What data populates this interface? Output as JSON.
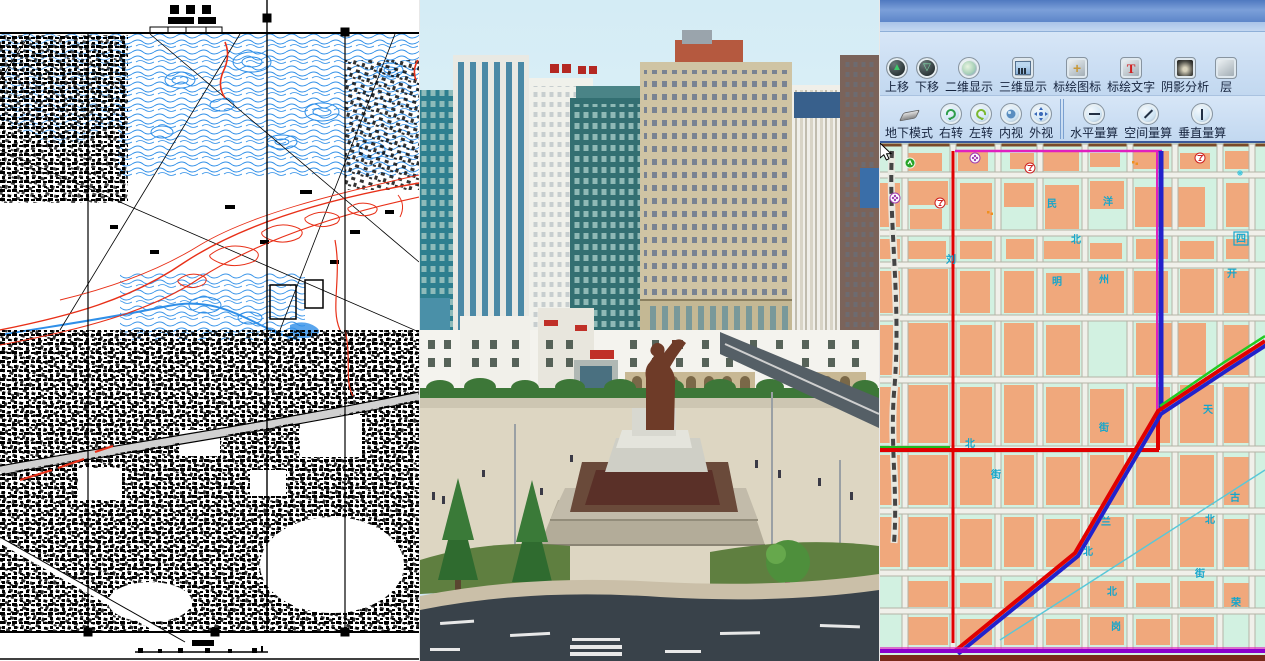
{
  "composite": {
    "panels": [
      "cad-topographic-map",
      "3d-city-model-view",
      "gis-application"
    ]
  },
  "left_panel": {
    "type": "scanned CAD/topographic city map",
    "colors": {
      "ink": "#000000",
      "contour_blue": "#2f8fe8",
      "contour_red": "#e83018",
      "paper": "#ffffff"
    }
  },
  "middle_panel": {
    "type": "3D virtual city scene with statue plaza",
    "colors": {
      "sky": "#d8edf5",
      "plaza": "#ddd6c2",
      "road": "#39424a",
      "statue": "#6e3b28"
    }
  },
  "right_panel": {
    "toolbar_row1": [
      {
        "label": "上移",
        "icon": "move-up-icon"
      },
      {
        "label": "下移",
        "icon": "move-down-icon"
      },
      {
        "label": "二维显示",
        "icon": "2d-view-icon"
      },
      {
        "label": "三维显示",
        "icon": "3d-view-icon"
      },
      {
        "label": "标绘图标",
        "icon": "plot-symbol-icon"
      },
      {
        "label": "标绘文字",
        "icon": "plot-text-icon"
      },
      {
        "label": "阴影分析",
        "icon": "shadow-analysis-icon"
      },
      {
        "label": "层",
        "icon": "layer-icon"
      }
    ],
    "toolbar_row2": [
      {
        "label": "地下模式",
        "icon": "underground-mode-icon"
      },
      {
        "label": "右转",
        "icon": "rotate-right-icon"
      },
      {
        "label": "左转",
        "icon": "rotate-left-icon"
      },
      {
        "label": "内视",
        "icon": "inner-view-icon"
      },
      {
        "label": "外视",
        "icon": "outer-view-icon"
      },
      {
        "label": "水平量算",
        "icon": "horizontal-measure-icon"
      },
      {
        "label": "空间量算",
        "icon": "spatial-measure-icon"
      },
      {
        "label": "垂直量算",
        "icon": "vertical-measure-icon"
      }
    ],
    "map": {
      "colors": {
        "background": "#d2f1e1",
        "block": "#f0a87c",
        "street": "#f0f0ea",
        "street_edge": "#b4b4a6",
        "route_red": "#e00000",
        "route_blue": "#2222cc",
        "route_green": "#22bb22",
        "route_magenta": "#e020c0",
        "route_purple": "#8a00cc",
        "label_cyan": "#14a6cc"
      },
      "cursor": {
        "x": 133,
        "y": 45
      },
      "street_labels": [
        {
          "t": "民",
          "x": 172,
          "y": 64
        },
        {
          "t": "洋",
          "x": 228,
          "y": 62
        },
        {
          "t": "北",
          "x": 196,
          "y": 100
        },
        {
          "t": "四",
          "x": 361,
          "y": 99,
          "box": true
        },
        {
          "t": "刘",
          "x": 71,
          "y": 120
        },
        {
          "t": "州",
          "x": 224,
          "y": 140
        },
        {
          "t": "明",
          "x": 177,
          "y": 142
        },
        {
          "t": "开",
          "x": 352,
          "y": 134
        },
        {
          "t": "北",
          "x": 90,
          "y": 304
        },
        {
          "t": "街",
          "x": 116,
          "y": 335
        },
        {
          "t": "天",
          "x": 328,
          "y": 270
        },
        {
          "t": "街",
          "x": 224,
          "y": 288
        },
        {
          "t": "古",
          "x": 355,
          "y": 358
        },
        {
          "t": "兰",
          "x": 226,
          "y": 382
        },
        {
          "t": "北",
          "x": 330,
          "y": 380
        },
        {
          "t": "北",
          "x": 208,
          "y": 412
        },
        {
          "t": "街",
          "x": 320,
          "y": 434
        },
        {
          "t": "北",
          "x": 232,
          "y": 452
        },
        {
          "t": "岗",
          "x": 236,
          "y": 487
        },
        {
          "t": "荣",
          "x": 356,
          "y": 463
        }
      ],
      "blocks": [
        [
          28,
          10,
          34,
          18
        ],
        [
          78,
          8,
          30,
          20
        ],
        [
          130,
          10,
          24,
          16
        ],
        [
          163,
          8,
          36,
          20
        ],
        [
          210,
          10,
          30,
          14
        ],
        [
          253,
          8,
          36,
          18
        ],
        [
          300,
          10,
          30,
          16
        ],
        [
          345,
          8,
          26,
          18
        ],
        [
          0,
          40,
          20,
          44
        ],
        [
          28,
          38,
          40,
          24
        ],
        [
          30,
          66,
          32,
          20
        ],
        [
          80,
          40,
          32,
          46
        ],
        [
          124,
          40,
          30,
          24
        ],
        [
          165,
          42,
          34,
          44
        ],
        [
          210,
          38,
          34,
          28
        ],
        [
          255,
          44,
          70,
          40
        ],
        [
          346,
          40,
          26,
          44
        ],
        [
          0,
          96,
          20,
          20
        ],
        [
          28,
          98,
          38,
          18
        ],
        [
          80,
          98,
          32,
          18
        ],
        [
          126,
          96,
          28,
          20
        ],
        [
          164,
          98,
          36,
          18
        ],
        [
          210,
          100,
          32,
          16
        ],
        [
          256,
          96,
          32,
          20
        ],
        [
          300,
          98,
          34,
          18
        ],
        [
          346,
          96,
          26,
          20
        ],
        [
          0,
          128,
          20,
          42
        ],
        [
          28,
          126,
          40,
          44
        ],
        [
          80,
          128,
          30,
          42
        ],
        [
          124,
          128,
          30,
          42
        ],
        [
          166,
          130,
          34,
          40
        ],
        [
          208,
          128,
          36,
          42
        ],
        [
          254,
          128,
          34,
          42
        ],
        [
          300,
          126,
          34,
          44
        ],
        [
          344,
          128,
          28,
          42
        ],
        [
          0,
          182,
          20,
          50
        ],
        [
          28,
          180,
          40,
          52
        ],
        [
          80,
          182,
          32,
          50
        ],
        [
          124,
          180,
          30,
          52
        ],
        [
          166,
          182,
          34,
          50
        ],
        [
          256,
          180,
          70,
          52
        ],
        [
          344,
          182,
          28,
          50
        ],
        [
          0,
          244,
          20,
          56
        ],
        [
          28,
          242,
          40,
          58
        ],
        [
          80,
          244,
          32,
          56
        ],
        [
          124,
          242,
          30,
          58
        ],
        [
          166,
          244,
          34,
          56
        ],
        [
          210,
          246,
          34,
          54
        ],
        [
          256,
          244,
          34,
          56
        ],
        [
          300,
          242,
          34,
          58
        ],
        [
          344,
          244,
          28,
          56
        ],
        [
          0,
          312,
          20,
          50
        ],
        [
          28,
          312,
          40,
          50
        ],
        [
          80,
          314,
          32,
          48
        ],
        [
          124,
          312,
          30,
          50
        ],
        [
          166,
          314,
          34,
          48
        ],
        [
          210,
          312,
          34,
          50
        ],
        [
          256,
          314,
          34,
          48
        ],
        [
          300,
          312,
          34,
          50
        ],
        [
          344,
          314,
          28,
          48
        ],
        [
          0,
          374,
          20,
          50
        ],
        [
          28,
          374,
          40,
          50
        ],
        [
          80,
          376,
          32,
          48
        ],
        [
          124,
          374,
          30,
          50
        ],
        [
          166,
          376,
          34,
          48
        ],
        [
          210,
          374,
          34,
          50
        ],
        [
          256,
          376,
          34,
          48
        ],
        [
          300,
          374,
          34,
          50
        ],
        [
          344,
          376,
          28,
          48
        ],
        [
          28,
          438,
          40,
          26
        ],
        [
          80,
          440,
          32,
          24
        ],
        [
          124,
          438,
          30,
          26
        ],
        [
          166,
          440,
          34,
          24
        ],
        [
          210,
          438,
          34,
          26
        ],
        [
          256,
          440,
          34,
          24
        ],
        [
          300,
          438,
          34,
          26
        ],
        [
          344,
          440,
          28,
          24
        ],
        [
          28,
          474,
          40,
          28
        ],
        [
          80,
          476,
          32,
          26
        ],
        [
          124,
          474,
          30,
          28
        ],
        [
          166,
          476,
          34,
          26
        ],
        [
          210,
          474,
          34,
          28
        ],
        [
          256,
          476,
          34,
          26
        ],
        [
          300,
          474,
          34,
          28
        ]
      ],
      "pois": [
        {
          "t": "green",
          "x": 30,
          "y": 20
        },
        {
          "t": "flower",
          "x": 95,
          "y": 15
        },
        {
          "t": "glass",
          "x": 150,
          "y": 25
        },
        {
          "t": "dots",
          "x": 255,
          "y": 20
        },
        {
          "t": "glass",
          "x": 320,
          "y": 15
        },
        {
          "t": "snow",
          "x": 360,
          "y": 30
        },
        {
          "t": "flower",
          "x": 15,
          "y": 55
        },
        {
          "t": "glass",
          "x": 60,
          "y": 60
        },
        {
          "t": "dots",
          "x": 110,
          "y": 70
        },
        {
          "t": "white",
          "x": 140,
          "y": 55
        },
        {
          "t": "snow",
          "x": 190,
          "y": 60
        },
        {
          "t": "glass",
          "x": 230,
          "y": 70
        },
        {
          "t": "dots",
          "x": 270,
          "y": 55
        },
        {
          "t": "flower",
          "x": 340,
          "y": 60
        },
        {
          "t": "glass",
          "x": 370,
          "y": 75
        },
        {
          "t": "glass",
          "x": 20,
          "y": 110
        },
        {
          "t": "green",
          "x": 75,
          "y": 105
        },
        {
          "t": "flower",
          "x": 130,
          "y": 115
        },
        {
          "t": "dots",
          "x": 185,
          "y": 108
        },
        {
          "t": "glass",
          "x": 240,
          "y": 112
        },
        {
          "t": "flower",
          "x": 295,
          "y": 105
        },
        {
          "t": "blue",
          "x": 350,
          "y": 115
        },
        {
          "t": "dots",
          "x": 30,
          "y": 150
        },
        {
          "t": "glass",
          "x": 90,
          "y": 160
        },
        {
          "t": "flower",
          "x": 150,
          "y": 150
        },
        {
          "t": "dots",
          "x": 210,
          "y": 158
        },
        {
          "t": "glass",
          "x": 265,
          "y": 150
        },
        {
          "t": "green",
          "x": 330,
          "y": 155
        },
        {
          "t": "flower",
          "x": 25,
          "y": 200
        },
        {
          "t": "glass",
          "x": 85,
          "y": 210
        },
        {
          "t": "dots",
          "x": 140,
          "y": 205
        },
        {
          "t": "snow",
          "x": 200,
          "y": 210
        },
        {
          "t": "glass",
          "x": 260,
          "y": 200
        },
        {
          "t": "flower",
          "x": 320,
          "y": 212
        },
        {
          "t": "dots",
          "x": 365,
          "y": 205
        },
        {
          "t": "glass",
          "x": 40,
          "y": 260
        },
        {
          "t": "flower",
          "x": 100,
          "y": 270
        },
        {
          "t": "dots",
          "x": 160,
          "y": 262
        },
        {
          "t": "glass",
          "x": 220,
          "y": 268
        },
        {
          "t": "green",
          "x": 280,
          "y": 260
        },
        {
          "t": "glass",
          "x": 345,
          "y": 270
        },
        {
          "t": "flower",
          "x": 30,
          "y": 330
        },
        {
          "t": "glass",
          "x": 90,
          "y": 340
        },
        {
          "t": "dots",
          "x": 150,
          "y": 332
        },
        {
          "t": "flower",
          "x": 210,
          "y": 340
        },
        {
          "t": "glass",
          "x": 270,
          "y": 330
        },
        {
          "t": "dots",
          "x": 330,
          "y": 342
        },
        {
          "t": "glass",
          "x": 50,
          "y": 390
        },
        {
          "t": "flower",
          "x": 110,
          "y": 400
        },
        {
          "t": "dots",
          "x": 170,
          "y": 392
        },
        {
          "t": "green",
          "x": 230,
          "y": 400
        },
        {
          "t": "glass",
          "x": 290,
          "y": 390
        },
        {
          "t": "flower",
          "x": 350,
          "y": 402
        },
        {
          "t": "glass",
          "x": 60,
          "y": 450
        },
        {
          "t": "dots",
          "x": 120,
          "y": 460
        },
        {
          "t": "flower",
          "x": 180,
          "y": 452
        },
        {
          "t": "glass",
          "x": 240,
          "y": 460
        },
        {
          "t": "dots",
          "x": 300,
          "y": 450
        },
        {
          "t": "green",
          "x": 355,
          "y": 462
        },
        {
          "t": "flower",
          "x": 70,
          "y": 490
        },
        {
          "t": "glass",
          "x": 130,
          "y": 495
        },
        {
          "t": "green",
          "x": 62,
          "y": 212
        }
      ]
    }
  }
}
